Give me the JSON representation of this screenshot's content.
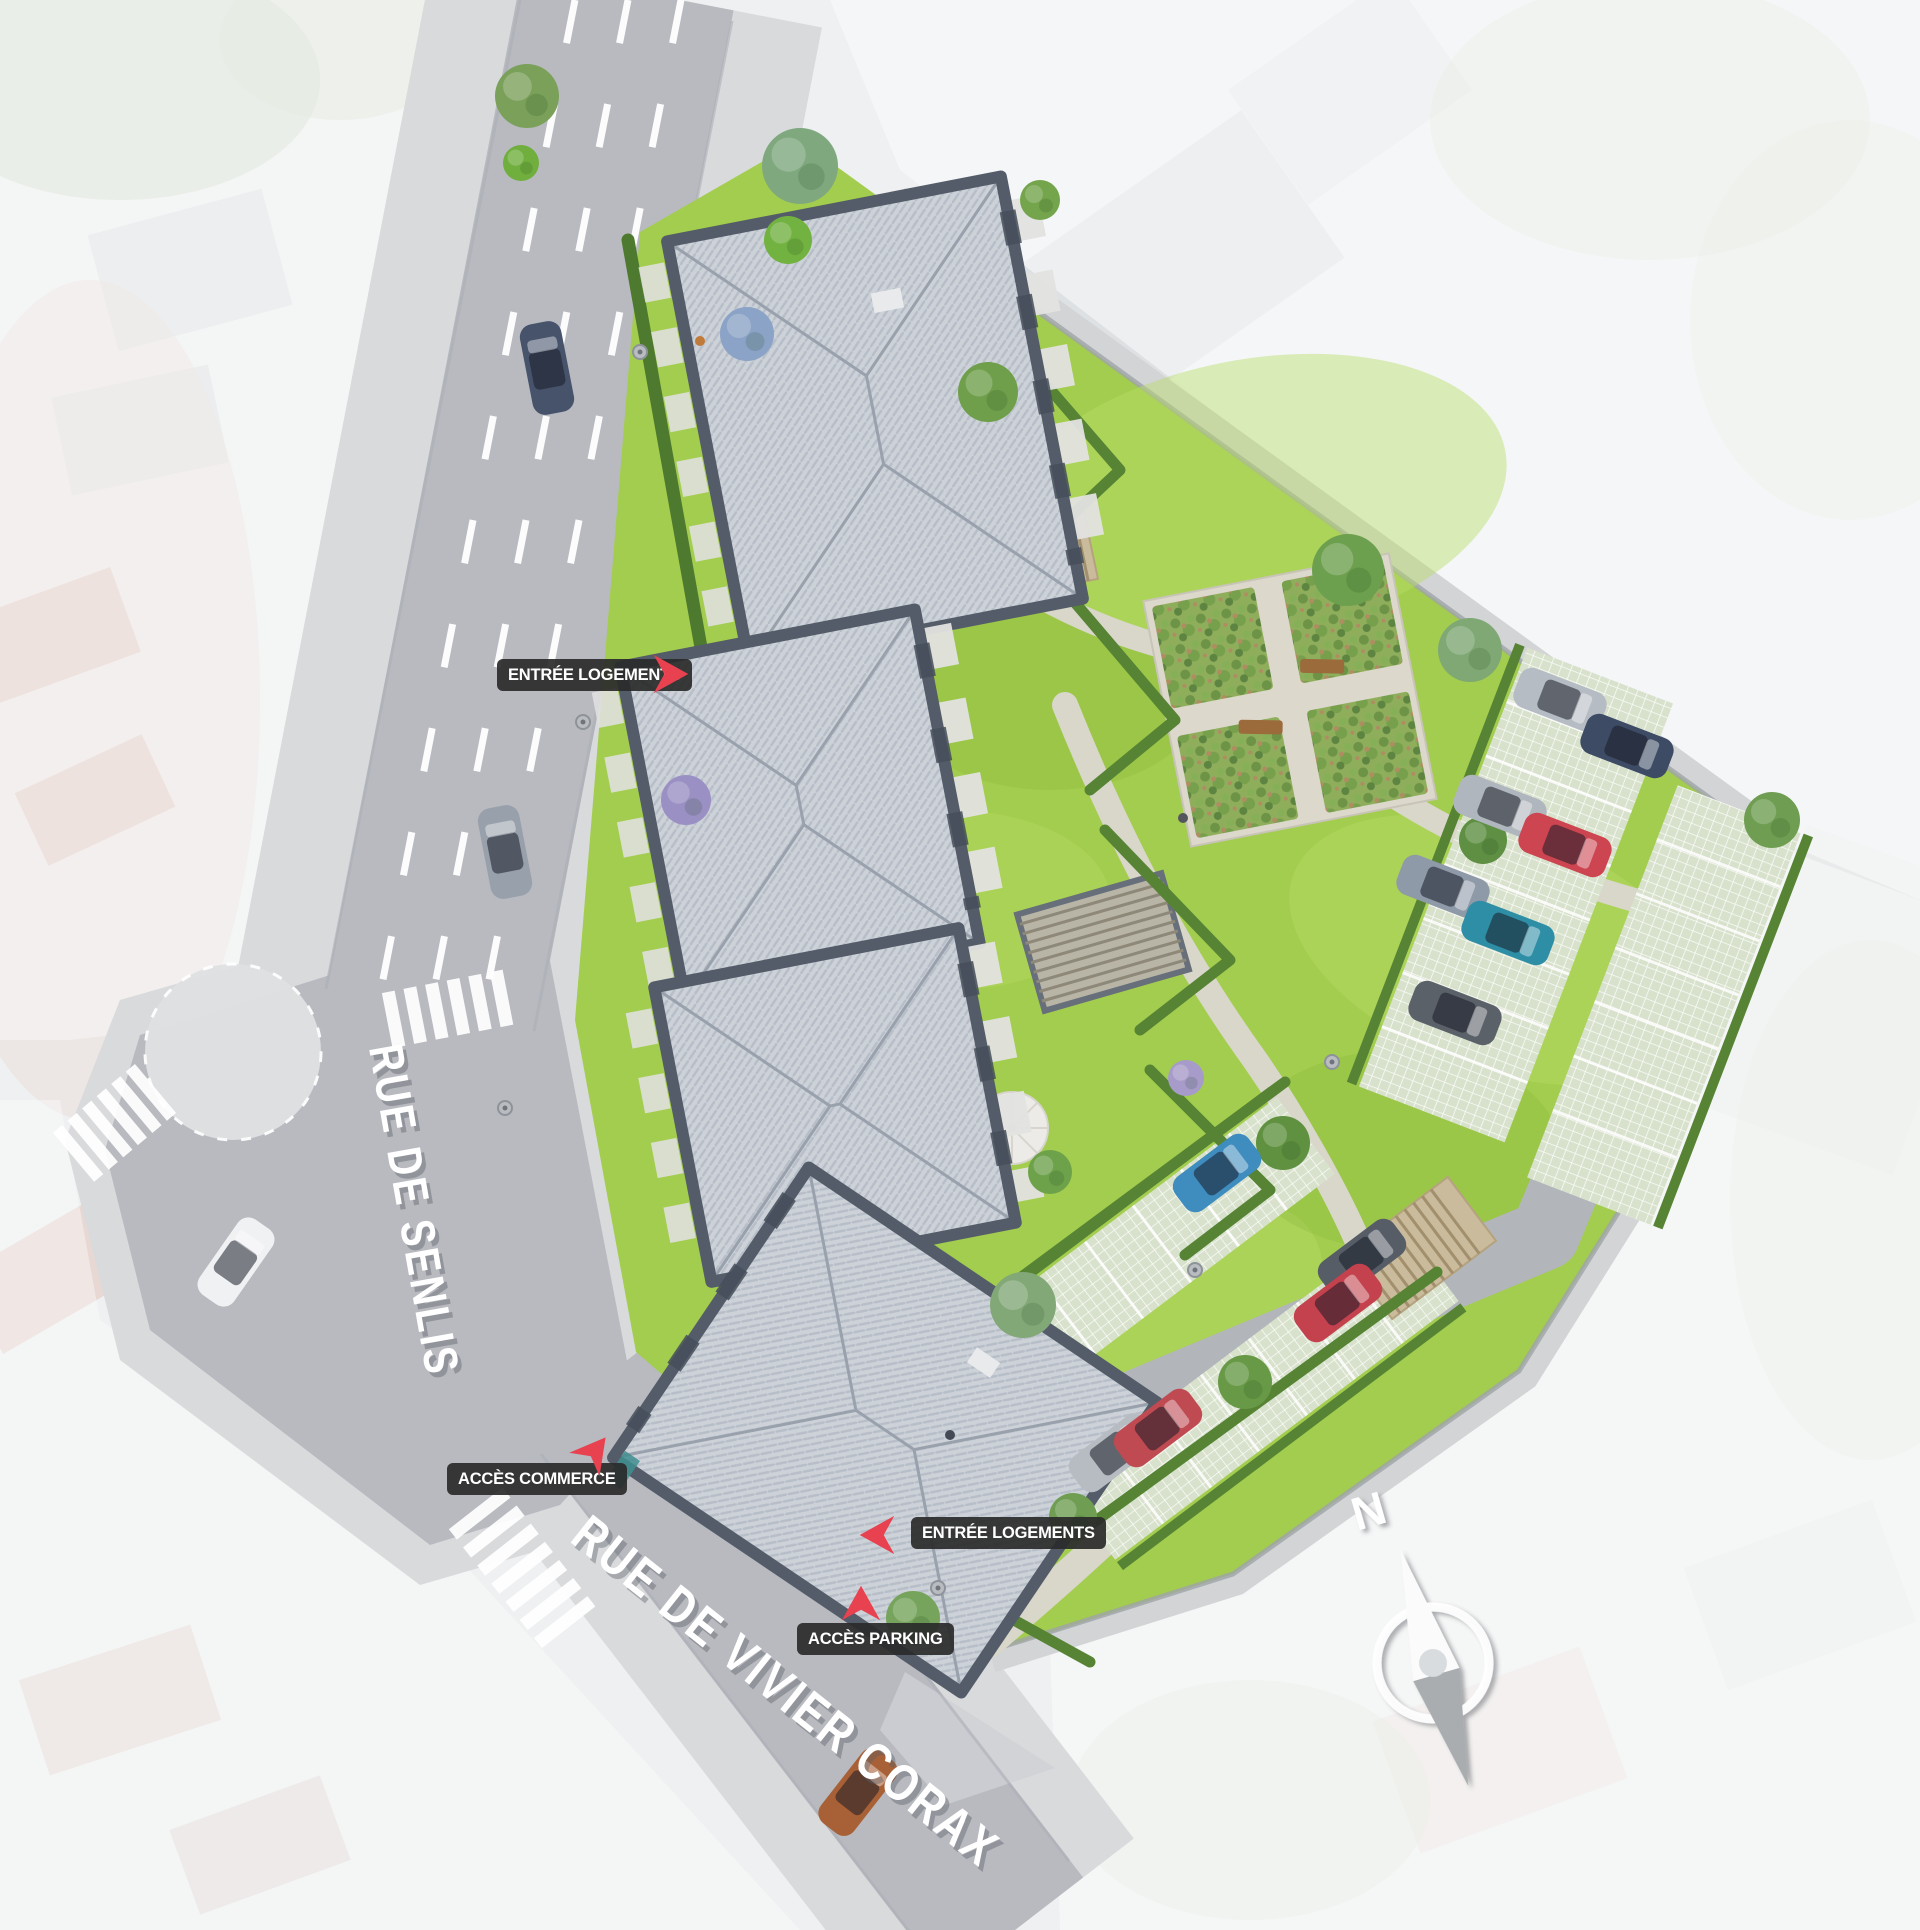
{
  "meta": {
    "title": "Plan de masse de la résidence"
  },
  "streets": {
    "senlis": "RUE DE SENLIS",
    "vivier_corax": "RUE DE VIVIER CORAX"
  },
  "labels": {
    "entree_logements_nord": "ENTRÉE LOGEMENTS",
    "acces_commerce": "ACCÈS COMMERCE",
    "entree_logements_sud": "ENTRÉE LOGEMENTS",
    "acces_parking": "ACCÈS PARKING"
  },
  "compass": {
    "north": "N"
  },
  "colors": {
    "accent_red": "#e8414f",
    "label_bg": "#2a2a2a",
    "label_text": "#ffffff",
    "grass": "#a3cd4e",
    "road": "#b8bac0",
    "sidewalk": "#d9dadc",
    "roof": "#cdd2d9",
    "roof_dark_edge": "#535c68",
    "hedge": "#568434",
    "paver": "#d8e1cc",
    "compass_gray": "#a9adb0"
  },
  "illustration": {
    "cars": [
      [
        547,
        368,
        -11,
        "#46536b"
      ],
      [
        505,
        852,
        -11,
        "#98a0ab"
      ],
      [
        236,
        1262,
        35,
        "#f0f1f3"
      ],
      [
        858,
        1792,
        38,
        "#a86036"
      ],
      [
        1560,
        700,
        111,
        "#b6bcc3"
      ],
      [
        1627,
        746,
        111,
        "#3d4b64"
      ],
      [
        1500,
        807,
        111,
        "#b0b6bd"
      ],
      [
        1565,
        845,
        111,
        "#cc4550"
      ],
      [
        1443,
        887,
        111,
        "#8f9aa8"
      ],
      [
        1508,
        933,
        111,
        "#2e8ea6"
      ],
      [
        1455,
        1013,
        111,
        "#5b6169"
      ],
      [
        1217,
        1173,
        53,
        "#3f8cbf"
      ],
      [
        1362,
        1258,
        53,
        "#565d66"
      ],
      [
        1338,
        1303,
        53,
        "#c4424e"
      ],
      [
        1113,
        1453,
        53,
        "#b7bcc2"
      ],
      [
        1158,
        1428,
        53,
        "#bf4a52"
      ]
    ],
    "trees": [
      [
        800,
        166,
        38,
        "#7fa87f"
      ],
      [
        788,
        240,
        24,
        "#72b241"
      ],
      [
        747,
        334,
        27,
        "#8ba3c6"
      ],
      [
        686,
        800,
        25,
        "#9a90c4"
      ],
      [
        988,
        392,
        30,
        "#6f9f4b"
      ],
      [
        1040,
        200,
        20,
        "#74a44c"
      ],
      [
        1348,
        570,
        36,
        "#6da04e"
      ],
      [
        1470,
        650,
        32,
        "#7fa874"
      ],
      [
        1772,
        820,
        28,
        "#6f9e52"
      ],
      [
        1483,
        840,
        24,
        "#5e8f43"
      ],
      [
        1186,
        1078,
        18,
        "#a79cc9"
      ],
      [
        1023,
        1305,
        33,
        "#83a878"
      ],
      [
        1283,
        1143,
        27,
        "#5f9140"
      ],
      [
        1050,
        1172,
        22,
        "#6da24b"
      ],
      [
        1245,
        1382,
        27,
        "#679946"
      ],
      [
        913,
        1618,
        27,
        "#76a45c"
      ],
      [
        1073,
        1517,
        24,
        "#6f9e52"
      ],
      [
        527,
        96,
        32,
        "#7ba05a"
      ],
      [
        521,
        163,
        18,
        "#70ae3e"
      ]
    ],
    "lamps": [
      [
        640,
        352
      ],
      [
        583,
        722
      ],
      [
        505,
        1108
      ],
      [
        1195,
        1270
      ],
      [
        1332,
        1062
      ],
      [
        938,
        1588
      ]
    ],
    "people": [
      [
        700,
        341,
        "#c07a3a"
      ],
      [
        1183,
        818,
        "#53565c"
      ],
      [
        950,
        1435,
        "#444a56"
      ]
    ]
  }
}
